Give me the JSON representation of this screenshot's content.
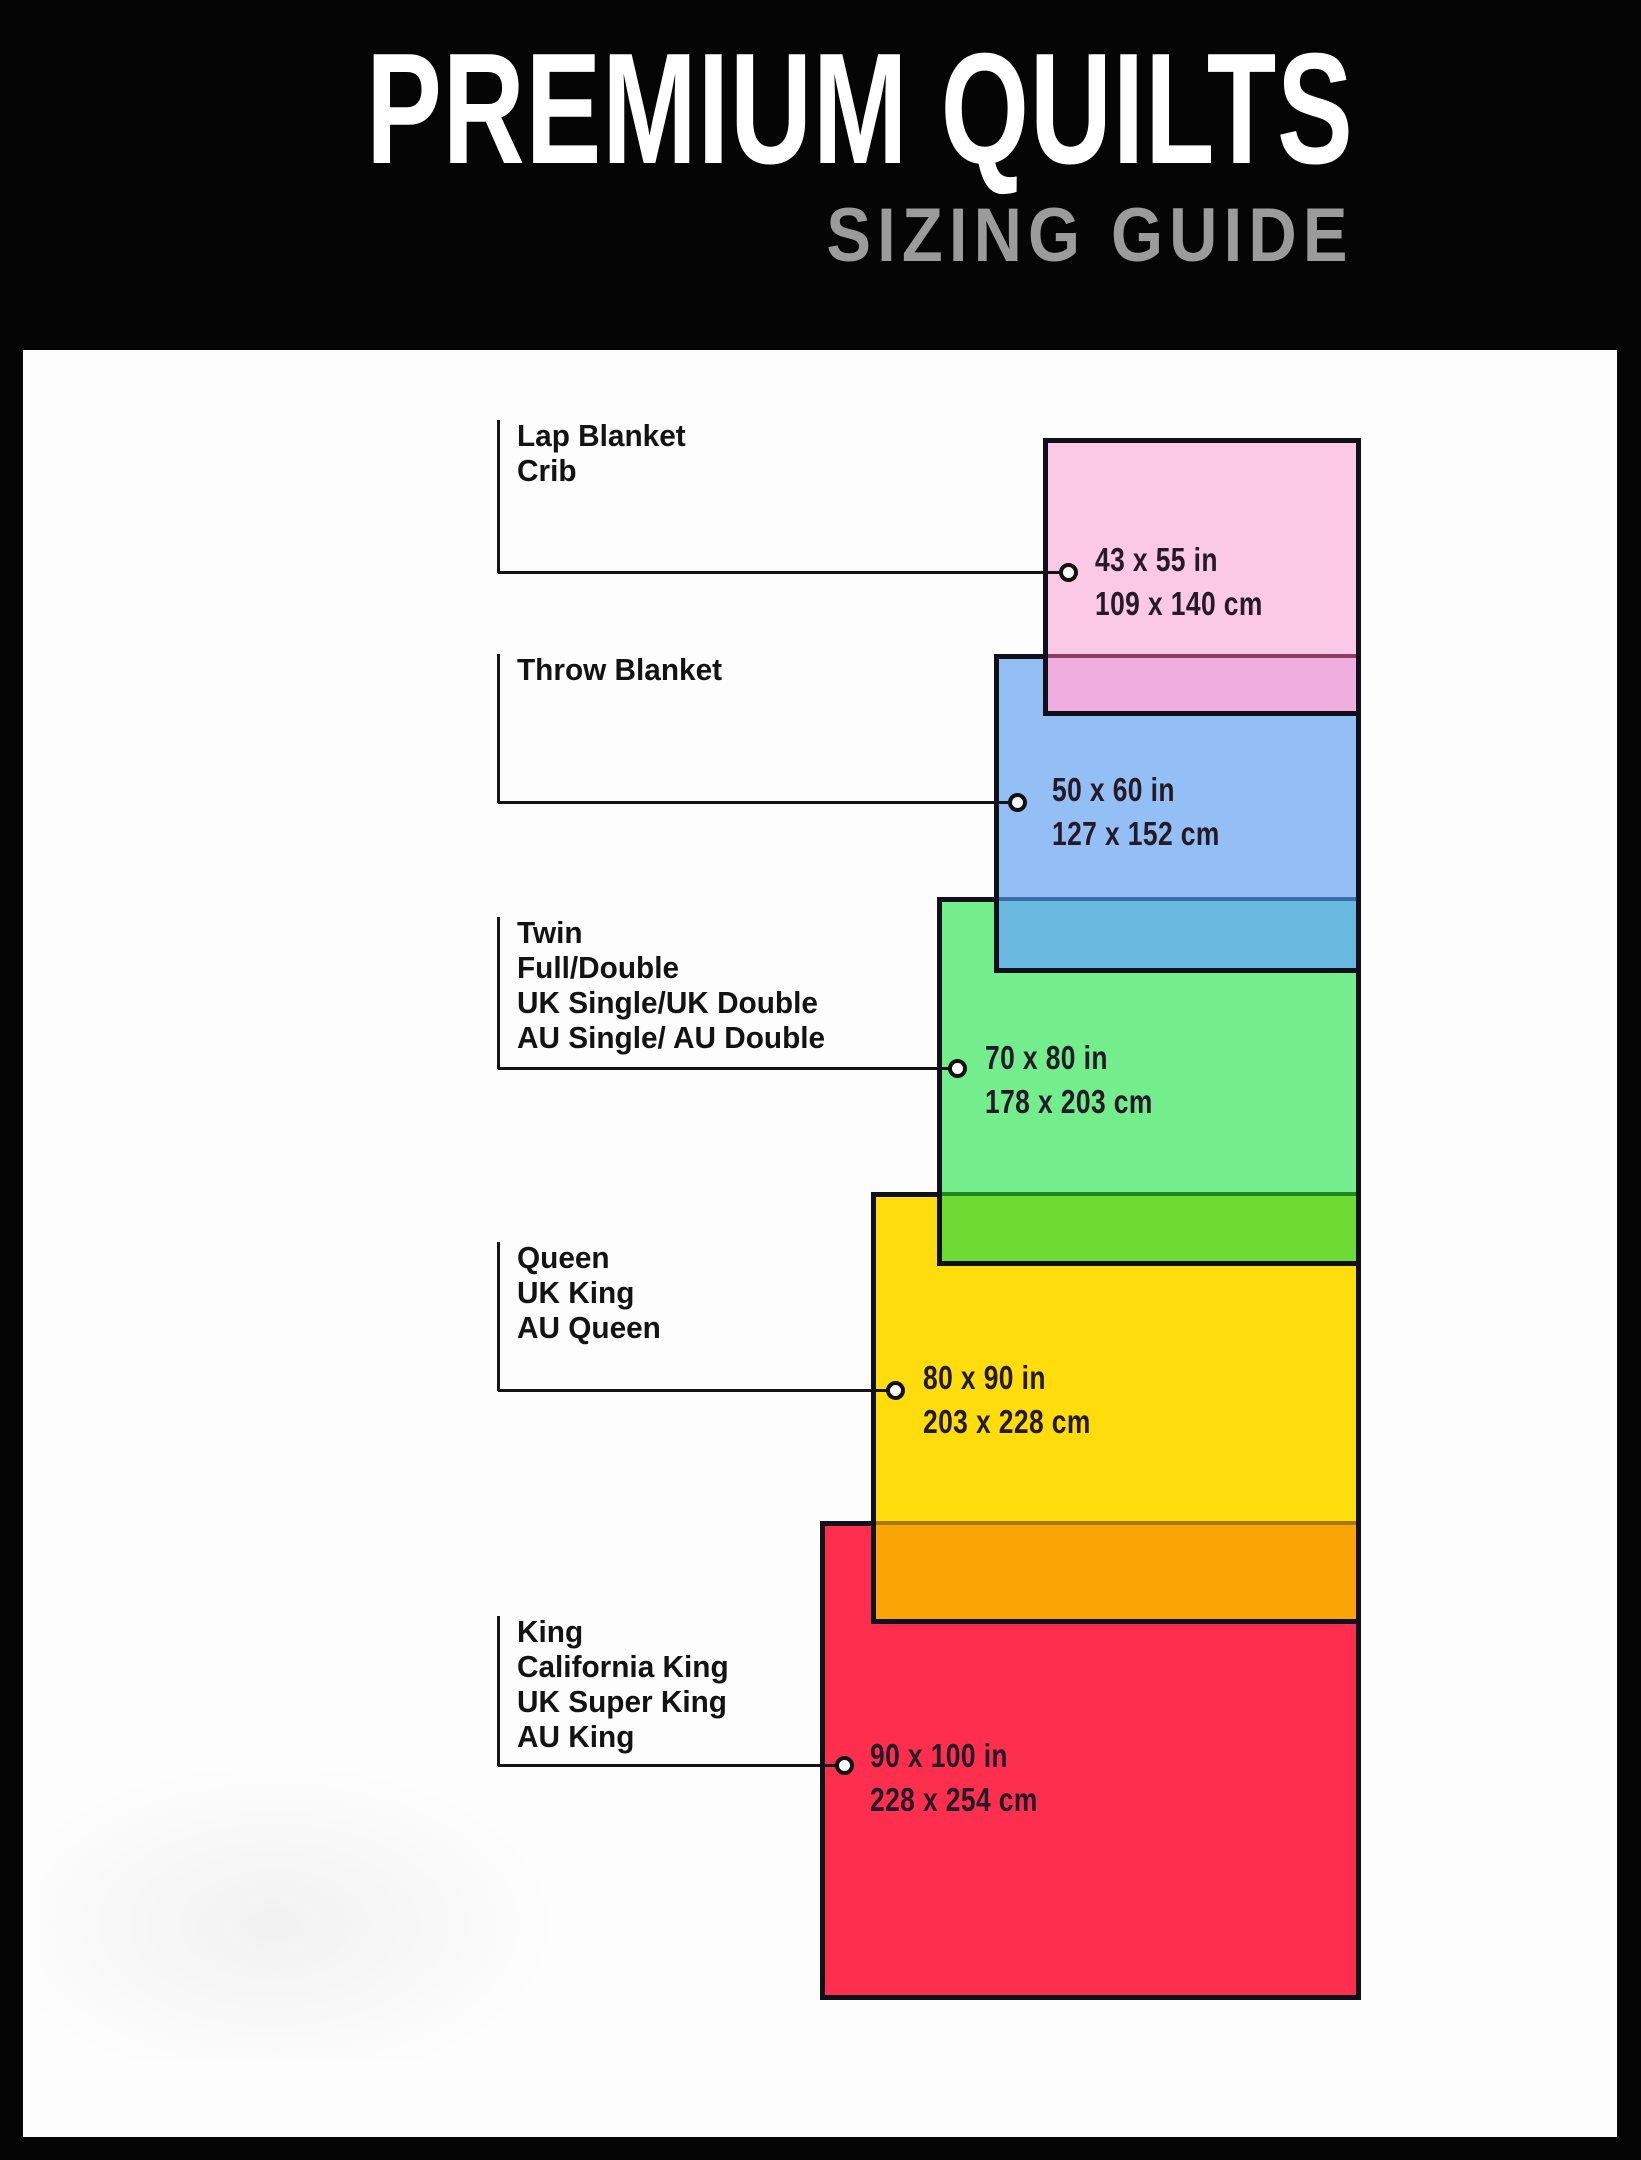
{
  "header": {
    "title": "PREMIUM QUILTS",
    "subtitle": "SIZING GUIDE",
    "background": "#050505",
    "title_color": "#ffffff",
    "subtitle_color": "#9b9b9b"
  },
  "canvas": {
    "panel_background": "#fdfdfd",
    "frame_color": "#050505",
    "connector_color": "#141414",
    "rect_border_color": "#10101a"
  },
  "sizes": [
    {
      "id": "lap-blanket-crib",
      "names": [
        "Lap Blanket",
        "Crib"
      ],
      "inches": "43 x 55 in",
      "cm": "109 x 140 cm",
      "fill": "#fbc8e5",
      "overlap_fill": "#efaedd",
      "overlap_line": "#8c3a66",
      "layout": {
        "rect": [
          1043,
          438,
          318,
          278
        ],
        "overlap_top": 654,
        "label_top": 418,
        "connector_y": 572,
        "circle_x": 1068,
        "dims_pos": [
          1095,
          538
        ]
      }
    },
    {
      "id": "throw-blanket",
      "names": [
        "Throw Blanket"
      ],
      "inches": "50 x 60 in",
      "cm": "127 x 152 cm",
      "fill": "#93bff5",
      "overlap_fill": "#68b8df",
      "overlap_line": "#3a6da8",
      "layout": {
        "rect": [
          994,
          654,
          367,
          319
        ],
        "overlap_top": 897,
        "label_top": 652,
        "connector_y": 802,
        "circle_x": 1017,
        "dims_pos": [
          1052,
          768
        ]
      }
    },
    {
      "id": "twin-full-double",
      "names": [
        "Twin",
        "Full/Double",
        "UK Single/UK Double",
        "AU Single/ AU Double"
      ],
      "inches": "70 x 80 in",
      "cm": "178 x 203 cm",
      "fill": "#74ee8c",
      "overlap_fill": "#6edb33",
      "overlap_line": "#21871f",
      "layout": {
        "rect": [
          937,
          897,
          424,
          369
        ],
        "overlap_top": 1192,
        "label_top": 915,
        "connector_y": 1068,
        "circle_x": 957,
        "dims_pos": [
          985,
          1036
        ]
      }
    },
    {
      "id": "queen",
      "names": [
        "Queen",
        "UK King",
        "AU Queen"
      ],
      "inches": "80 x 90 in",
      "cm": "203 x 228 cm",
      "fill": "#ffdc0b",
      "overlap_fill": "#f9a505",
      "overlap_line": "#a5770a",
      "layout": {
        "rect": [
          871,
          1192,
          490,
          432
        ],
        "overlap_top": 1521,
        "label_top": 1240,
        "connector_y": 1390,
        "circle_x": 895,
        "dims_pos": [
          923,
          1356
        ]
      }
    },
    {
      "id": "king",
      "names": [
        "King",
        "California King",
        "UK Super King",
        "AU King"
      ],
      "inches": "90 x 100 in",
      "cm": "228 x 254 cm",
      "fill": "#fd2e4e",
      "overlap_fill": null,
      "overlap_line": null,
      "layout": {
        "rect": [
          820,
          1521,
          541,
          479
        ],
        "overlap_top": null,
        "label_top": 1614,
        "connector_y": 1765,
        "circle_x": 844,
        "dims_pos": [
          870,
          1734
        ]
      }
    }
  ]
}
